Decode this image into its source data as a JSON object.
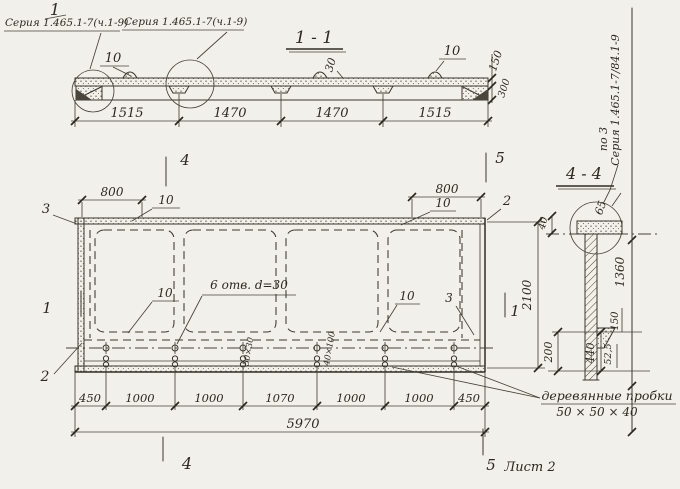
{
  "header": {
    "mark": "1",
    "callout_1": "Серия 1.465.1-7(ч.1-9)",
    "callout_2": "Серия 1.465.1-7(ч.1-9)"
  },
  "side_ref": {
    "prefix": "по 3",
    "series": "Серия 1.465.1-7/84.1-9"
  },
  "section_1_1": {
    "title": "1 - 1",
    "label_10_left": "10",
    "label_10_right": "10",
    "label_30": "30",
    "dim_150": "150",
    "dim_300": "300",
    "dims": [
      "1515",
      "1470",
      "1470",
      "1515"
    ]
  },
  "plan": {
    "dim_800_left": "800",
    "dim_800_right": "800",
    "label_10_top_left": "10",
    "label_10_top_right": "10",
    "label_3_left": "3",
    "label_2_top_right": "2",
    "label_10_inner_left": "10",
    "label_10_inner_right": "10",
    "label_3_inner_right": "3",
    "label_2_bottom_left": "2",
    "holes_note": "6 отв. d=30",
    "slot_label_a": "50×30",
    "slot_label_b": "40×100",
    "dim_2100": "2100",
    "dims_bottom": [
      "450",
      "1000",
      "1000",
      "1070",
      "1000",
      "1000",
      "450"
    ],
    "dim_total": "5970"
  },
  "plugs_note": {
    "line1": "деревянные пробки",
    "line2": "50 × 50 × 40"
  },
  "section_4_4": {
    "title": "4 - 4",
    "dim_40": "40",
    "dim_65": "65",
    "dim_1360": "1360",
    "dim_200": "200",
    "dim_440": "440",
    "dim_52_5": "52,5",
    "dim_150": "150"
  },
  "markers": {
    "m4_top": "4",
    "m5_top": "5",
    "m4_bottom": "4",
    "m5_bottom": "5",
    "m1_left": "1",
    "m1_right": "1",
    "sheet": "Лист 2"
  }
}
